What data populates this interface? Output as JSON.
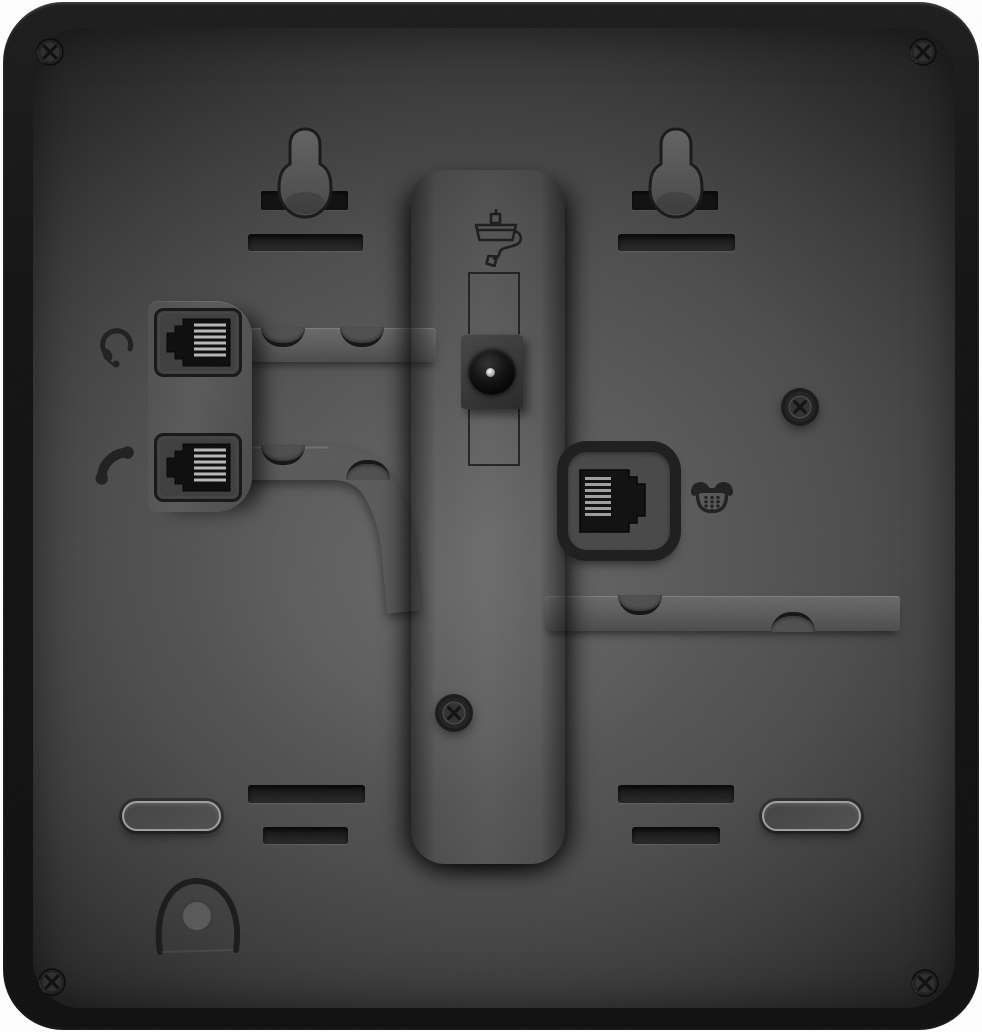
{
  "meta": {
    "title": "Rear panel of a black desk IP phone",
    "image_type": "product-photo",
    "visible_text": "none"
  },
  "palette": {
    "background": "#ffffff",
    "body_edge": "#101010",
    "panel_center": "#5e5e5e",
    "panel_edge": "#1e1e1e",
    "raised_plate": "#545454",
    "cable_channel": "#585858",
    "recessed_slot": "#151515",
    "jack_face": "#3c3c3c",
    "jack_hole": "#0a0a0a",
    "contact_pins": "#c8c8c8",
    "engraved_icon": "#1d1d1d",
    "foot_outline": "#9e9e9e",
    "dc_pin_highlight": "#ffffff"
  },
  "parts": {
    "body": "Phone body (rear shell)",
    "panel": "Rear panel surface",
    "keyhole_left": "Wall-mount keyhole (upper left)",
    "keyhole_right": "Wall-mount keyhole (upper right)",
    "wall_slot_left": "Wall-mount bracket slot (left)",
    "wall_slot_right": "Wall-mount bracket slot (right)",
    "stand_column": "Stand mounting column",
    "power_icon": "Power adapter engraving",
    "power_channel": "Power cord routing groove",
    "power_jack": "DC power input barrel connector",
    "ports_plate": "Headset / handset port plate",
    "headset_icon": "Headset engraving",
    "headset_port": "Headset jack (RJ9)",
    "handset_icon": "Handset engraving",
    "handset_port": "Handset jack (RJ9)",
    "line_port": "Telephone line jack (RJ11)",
    "phone_icon": "Telephone engraving",
    "channel_headset": "Headset cable routing channel",
    "channel_handset": "Handset cable routing channel",
    "channel_line": "Line cable routing channel",
    "stand_slot_upper_left": "Stand latch slot (upper left)",
    "stand_slot_lower_left": "Stand latch slot (lower left)",
    "stand_slot_upper_right": "Stand latch slot (upper right)",
    "stand_slot_lower_right": "Stand latch slot (lower right)",
    "foot_left": "Rubber foot (left)",
    "foot_right": "Rubber foot (right)",
    "cable_hook": "Cable tie anchor hook",
    "screw_corner": "Phillips case screw",
    "screw_boss": "Recessed Phillips screw"
  }
}
